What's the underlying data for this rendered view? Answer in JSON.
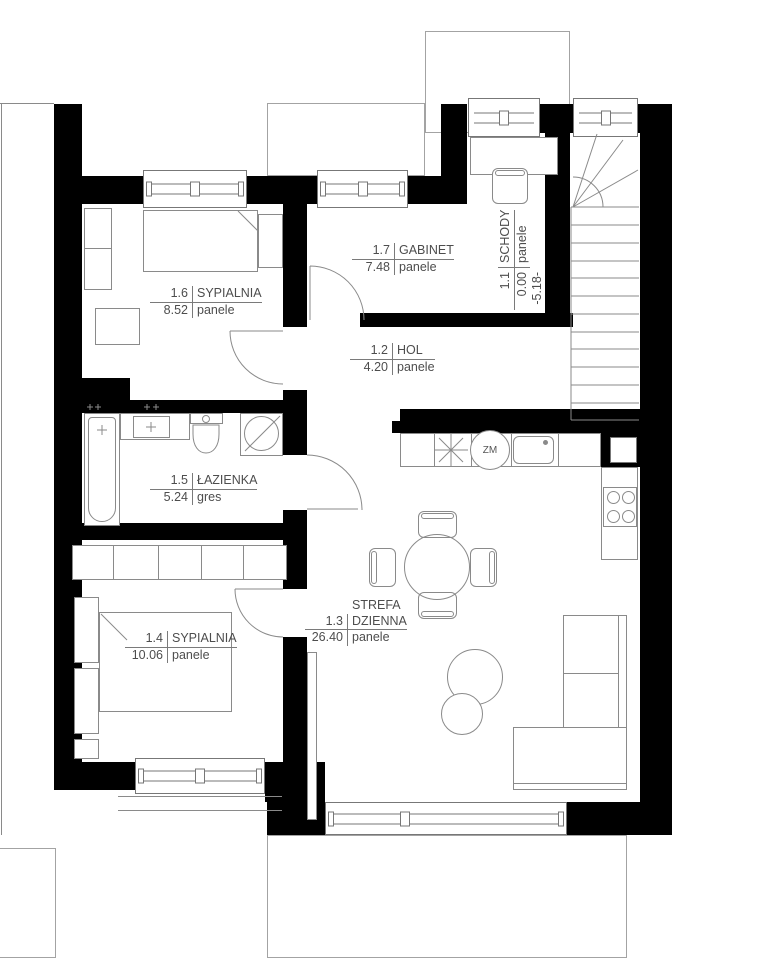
{
  "rooms": [
    {
      "id": "1.6",
      "name": "SYPIALNIA",
      "area": "8.52",
      "floor": "panele"
    },
    {
      "id": "1.7",
      "name": "GABINET",
      "area": "7.48",
      "floor": "panele"
    },
    {
      "id": "1.1",
      "name": "SCHODY",
      "area": "0.00",
      "floor": "panele",
      "level": "-5.18-"
    },
    {
      "id": "1.2",
      "name": "HOL",
      "area": "4.20",
      "floor": "panele"
    },
    {
      "id": "1.5",
      "name": "ŁAZIENKA",
      "area": "5.24",
      "floor": "gres"
    },
    {
      "id": "1.4",
      "name": "SYPIALNIA",
      "area": "10.06",
      "floor": "panele"
    },
    {
      "id": "1.3",
      "name_prefix": "STREFA",
      "name": "DZIENNA",
      "area": "26.40",
      "floor": "panele"
    }
  ],
  "symbols": {
    "dishwasher": "ZM"
  },
  "colors": {
    "wall": "#000000",
    "furniture_line": "#8a8a8a",
    "label_text": "#4d4d4d"
  }
}
